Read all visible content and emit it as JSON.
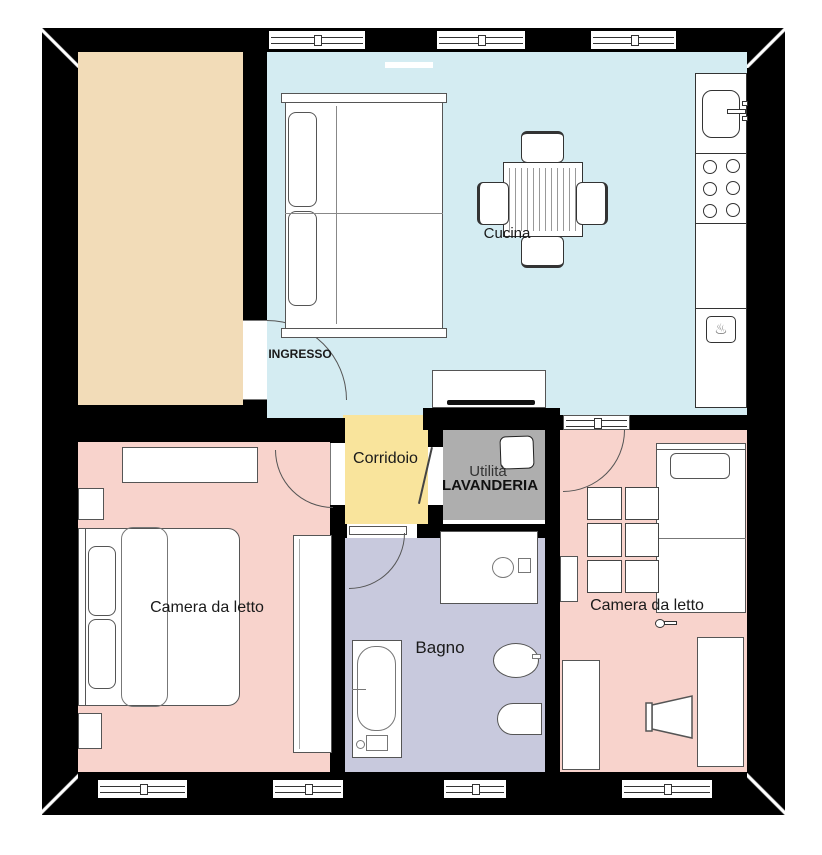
{
  "plan": {
    "labels": {
      "cucina": "Cucina",
      "ingresso": "INGRESSO",
      "corridoio": "Corridoio",
      "utilita": "Utilità",
      "lavanderia": "LAVANDERIA",
      "bagno": "Bagno",
      "camera_da_letto_sinistra": "Camera da letto",
      "camera_da_letto_destra": "Camera da letto"
    },
    "colors": {
      "wall": "#000000",
      "room_unlabeled": "#f2dcb8",
      "cucina": "#d4ecf2",
      "corridoio": "#f9e49c",
      "lavanderia": "#aeaeae",
      "bagno": "#c8c9dd",
      "camera_da_letto_sinistra": "#f8d3cc",
      "camera_da_letto_destra": "#f8d3cc",
      "furniture_line": "#555555"
    },
    "icons": {
      "oven": "♨"
    }
  }
}
